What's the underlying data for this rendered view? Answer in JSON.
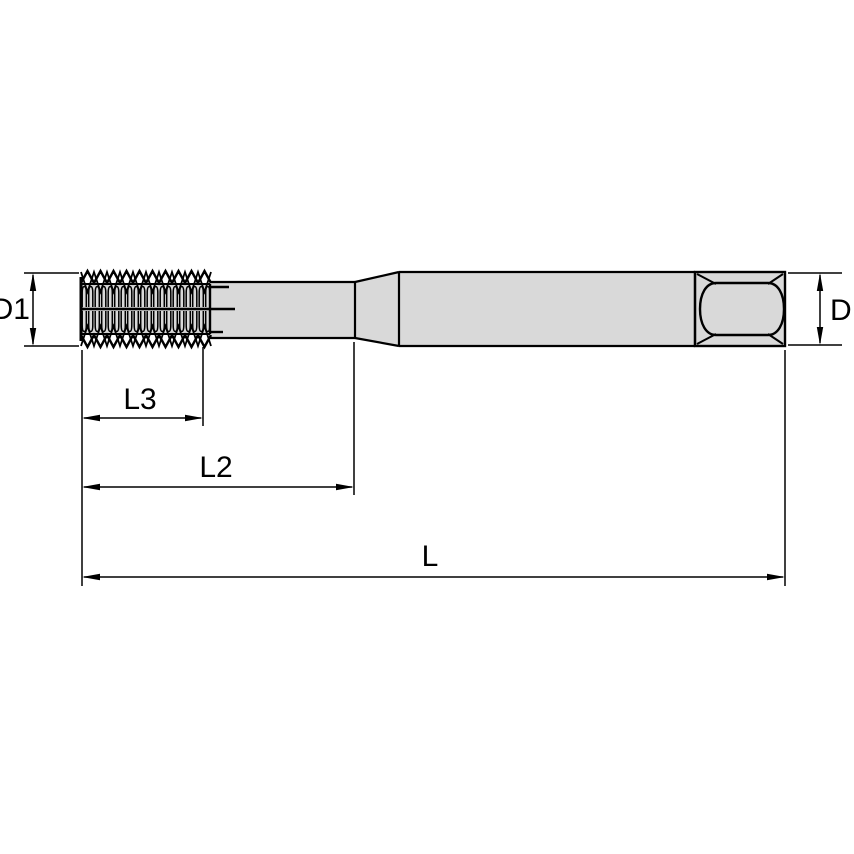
{
  "diagram": {
    "labels": {
      "d1": "D1",
      "d": "D",
      "l3": "L3",
      "l2": "L2",
      "l": "L"
    },
    "colors": {
      "body_fill": "#d9d9d9",
      "line": "#000000",
      "background": "#ffffff"
    }
  }
}
